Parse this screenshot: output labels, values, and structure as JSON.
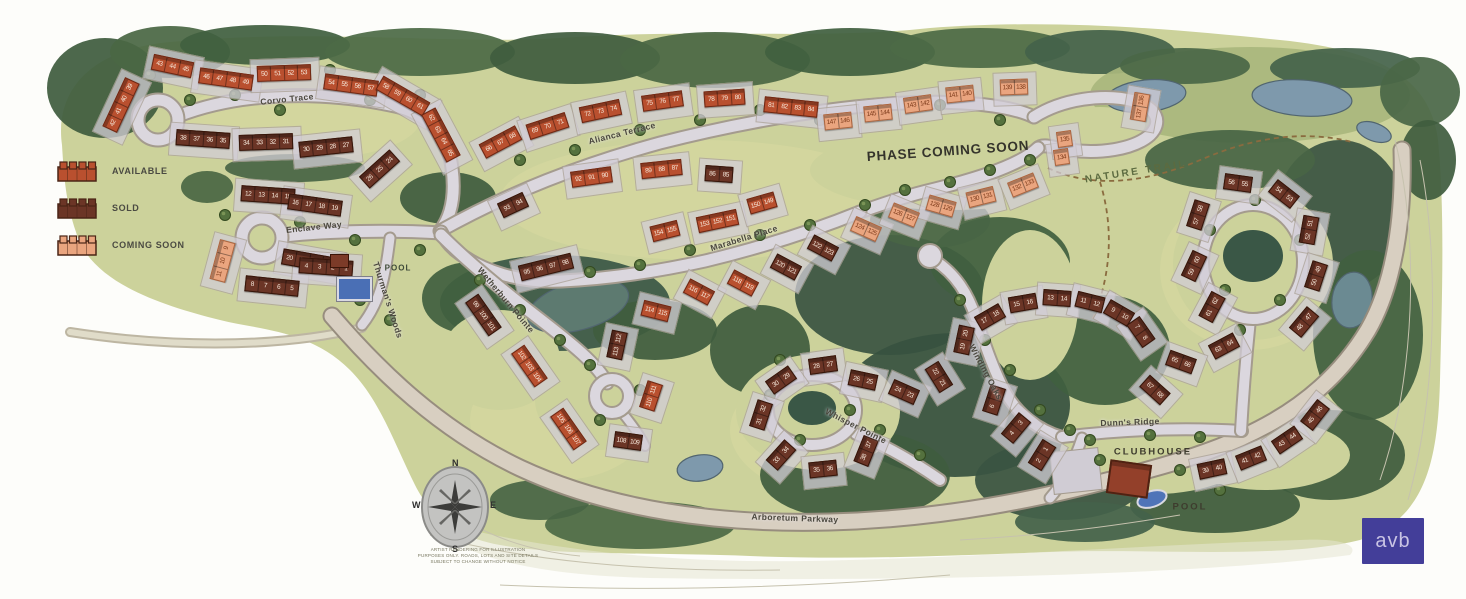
{
  "legend": {
    "items": [
      {
        "label": "AVAILABLE",
        "status": "available",
        "color": "#b9502f"
      },
      {
        "label": "SOLD",
        "status": "sold",
        "color": "#6b3526"
      },
      {
        "label": "COMING SOON",
        "status": "coming-soon",
        "color": "#eaa57f"
      }
    ]
  },
  "streets": [
    {
      "name": "Corvo Trace",
      "x": 287,
      "y": 99,
      "rot": -6
    },
    {
      "name": "Alianca Terrace",
      "x": 622,
      "y": 133,
      "rot": -14
    },
    {
      "name": "Enclave Way",
      "x": 314,
      "y": 227,
      "rot": -6
    },
    {
      "name": "Marabella Place",
      "x": 744,
      "y": 238,
      "rot": -17
    },
    {
      "name": "Wetherburn Pointe",
      "x": 506,
      "y": 300,
      "rot": 50
    },
    {
      "name": "Thurman's Woods",
      "x": 388,
      "y": 300,
      "rot": 72
    },
    {
      "name": "Whisper Pointe",
      "x": 856,
      "y": 426,
      "rot": 27
    },
    {
      "name": "Winding Oaks",
      "x": 986,
      "y": 372,
      "rot": 62
    },
    {
      "name": "Dunn's Ridge",
      "x": 1130,
      "y": 422,
      "rot": -2
    },
    {
      "name": "Arboretum Parkway",
      "x": 795,
      "y": 518,
      "rot": 2
    }
  ],
  "labels": [
    {
      "text": "PHASE COMING SOON",
      "x": 948,
      "y": 151,
      "rot": -4,
      "kind": "phase"
    },
    {
      "text": "NATURE TRAIL",
      "x": 1136,
      "y": 172,
      "rot": -9,
      "kind": "trail"
    },
    {
      "text": "POOL",
      "x": 398,
      "y": 268,
      "rot": 0,
      "kind": "small"
    },
    {
      "text": "CLUBHOUSE",
      "x": 1153,
      "y": 452,
      "rot": 0,
      "kind": "facility"
    },
    {
      "text": "POOL",
      "x": 1190,
      "y": 507,
      "rot": 0,
      "kind": "facility"
    }
  ],
  "compass": {
    "n": "N",
    "e": "E",
    "s": "S",
    "w": "W"
  },
  "disclaimer": {
    "lines": [
      "ARTIST RENDERING FOR ILLUSTRATION",
      "PURPOSES ONLY. ROADS, LOTS AND SITE DETAILS",
      "SUBJECT TO CHANGE WITHOUT NOTICE"
    ]
  },
  "logo": {
    "text": "avb"
  },
  "buildings": [
    {
      "lots": [
        "42",
        "41",
        "40",
        "39"
      ],
      "status": "available",
      "x": 121,
      "y": 106,
      "rot": -65
    },
    {
      "lots": [
        "43",
        "44",
        "45"
      ],
      "status": "available",
      "x": 172,
      "y": 67,
      "rot": 12
    },
    {
      "lots": [
        "46",
        "47",
        "48",
        "49"
      ],
      "status": "available",
      "x": 226,
      "y": 80,
      "rot": 8
    },
    {
      "lots": [
        "50",
        "51",
        "52",
        "53"
      ],
      "status": "available",
      "x": 284,
      "y": 74,
      "rot": -2
    },
    {
      "lots": [
        "54",
        "55",
        "56",
        "57"
      ],
      "status": "available",
      "x": 351,
      "y": 86,
      "rot": 8
    },
    {
      "lots": [
        "58",
        "59",
        "60",
        "61"
      ],
      "status": "available",
      "x": 403,
      "y": 97,
      "rot": 30
    },
    {
      "lots": [
        "62",
        "63",
        "64",
        "65"
      ],
      "status": "available",
      "x": 441,
      "y": 136,
      "rot": 62
    },
    {
      "lots": [
        "38",
        "37",
        "36",
        "35"
      ],
      "status": "sold",
      "x": 203,
      "y": 140,
      "rot": 4
    },
    {
      "lots": [
        "34",
        "33",
        "32",
        "31"
      ],
      "status": "sold",
      "x": 266,
      "y": 143,
      "rot": -2
    },
    {
      "lots": [
        "30",
        "29",
        "28",
        "27"
      ],
      "status": "sold",
      "x": 326,
      "y": 148,
      "rot": -6
    },
    {
      "lots": [
        "26",
        "25",
        "24"
      ],
      "status": "sold",
      "x": 379,
      "y": 170,
      "rot": -42
    },
    {
      "lots": [
        "12",
        "13",
        "14",
        "15"
      ],
      "status": "sold",
      "x": 268,
      "y": 196,
      "rot": 4
    },
    {
      "lots": [
        "16",
        "17",
        "18",
        "19"
      ],
      "status": "sold",
      "x": 315,
      "y": 206,
      "rot": 8
    },
    {
      "lots": [
        "20",
        "21",
        "22",
        "23"
      ],
      "status": "sold",
      "x": 309,
      "y": 262,
      "rot": 10
    },
    {
      "lots": [
        "11",
        "10",
        "9"
      ],
      "status": "coming-soon",
      "x": 222,
      "y": 262,
      "rot": -75
    },
    {
      "lots": [
        "8",
        "7",
        "6",
        "5"
      ],
      "status": "sold",
      "x": 272,
      "y": 287,
      "rot": 6
    },
    {
      "lots": [
        "4",
        "3",
        "2",
        "1"
      ],
      "status": "sold",
      "x": 326,
      "y": 268,
      "rot": 4
    },
    {
      "lots": [
        "66",
        "67",
        "68"
      ],
      "status": "available",
      "x": 500,
      "y": 143,
      "rot": -28
    },
    {
      "lots": [
        "69",
        "70",
        "71"
      ],
      "status": "available",
      "x": 547,
      "y": 127,
      "rot": -18
    },
    {
      "lots": [
        "72",
        "73",
        "74"
      ],
      "status": "available",
      "x": 600,
      "y": 112,
      "rot": -12
    },
    {
      "lots": [
        "75",
        "76",
        "77"
      ],
      "status": "available",
      "x": 662,
      "y": 102,
      "rot": -8
    },
    {
      "lots": [
        "78",
        "79",
        "80"
      ],
      "status": "available",
      "x": 724,
      "y": 99,
      "rot": -4
    },
    {
      "lots": [
        "81",
        "82",
        "83",
        "84"
      ],
      "status": "available",
      "x": 791,
      "y": 108,
      "rot": 6
    },
    {
      "lots": [
        "92",
        "91",
        "90"
      ],
      "status": "available",
      "x": 591,
      "y": 178,
      "rot": -8
    },
    {
      "lots": [
        "89",
        "88",
        "87"
      ],
      "status": "available",
      "x": 661,
      "y": 170,
      "rot": -6
    },
    {
      "lots": [
        "86",
        "85"
      ],
      "status": "sold",
      "x": 719,
      "y": 175,
      "rot": 4
    },
    {
      "lots": [
        "93",
        "94"
      ],
      "status": "sold",
      "x": 513,
      "y": 206,
      "rot": -25
    },
    {
      "lots": [
        "95",
        "96",
        "97",
        "98"
      ],
      "status": "sold",
      "x": 546,
      "y": 268,
      "rot": -14
    },
    {
      "lots": [
        "99",
        "100",
        "101"
      ],
      "status": "sold",
      "x": 483,
      "y": 316,
      "rot": 55
    },
    {
      "lots": [
        "102",
        "103",
        "104"
      ],
      "status": "available",
      "x": 529,
      "y": 367,
      "rot": 55
    },
    {
      "lots": [
        "105",
        "106",
        "107"
      ],
      "status": "available",
      "x": 568,
      "y": 430,
      "rot": 55
    },
    {
      "lots": [
        "108",
        "109"
      ],
      "status": "sold",
      "x": 628,
      "y": 442,
      "rot": 8
    },
    {
      "lots": [
        "110",
        "111"
      ],
      "status": "available",
      "x": 651,
      "y": 397,
      "rot": -72
    },
    {
      "lots": [
        "113",
        "112"
      ],
      "status": "sold",
      "x": 617,
      "y": 346,
      "rot": -78
    },
    {
      "lots": [
        "114",
        "115"
      ],
      "status": "available",
      "x": 656,
      "y": 312,
      "rot": 14
    },
    {
      "lots": [
        "116",
        "117"
      ],
      "status": "available",
      "x": 699,
      "y": 293,
      "rot": 28
    },
    {
      "lots": [
        "118",
        "119"
      ],
      "status": "available",
      "x": 743,
      "y": 284,
      "rot": 28
    },
    {
      "lots": [
        "120",
        "121"
      ],
      "status": "sold",
      "x": 786,
      "y": 268,
      "rot": 28
    },
    {
      "lots": [
        "122",
        "123"
      ],
      "status": "sold",
      "x": 823,
      "y": 249,
      "rot": 28
    },
    {
      "lots": [
        "154",
        "155"
      ],
      "status": "available",
      "x": 665,
      "y": 232,
      "rot": -14
    },
    {
      "lots": [
        "153",
        "152",
        "151"
      ],
      "status": "available",
      "x": 717,
      "y": 222,
      "rot": -12
    },
    {
      "lots": [
        "150",
        "149"
      ],
      "status": "available",
      "x": 762,
      "y": 204,
      "rot": -16
    },
    {
      "lots": [
        "124",
        "125"
      ],
      "status": "coming-soon",
      "x": 866,
      "y": 230,
      "rot": 24
    },
    {
      "lots": [
        "126",
        "127"
      ],
      "status": "coming-soon",
      "x": 904,
      "y": 216,
      "rot": 22
    },
    {
      "lots": [
        "128",
        "129"
      ],
      "status": "coming-soon",
      "x": 941,
      "y": 207,
      "rot": 16
    },
    {
      "lots": [
        "130",
        "131"
      ],
      "status": "coming-soon",
      "x": 981,
      "y": 198,
      "rot": -14
    },
    {
      "lots": [
        "132",
        "133"
      ],
      "status": "coming-soon",
      "x": 1023,
      "y": 186,
      "rot": -22
    },
    {
      "lots": [
        "134"
      ],
      "status": "coming-soon",
      "x": 1061,
      "y": 158,
      "rot": -8
    },
    {
      "lots": [
        "135"
      ],
      "status": "coming-soon",
      "x": 1064,
      "y": 140,
      "rot": -8
    },
    {
      "lots": [
        "147",
        "146"
      ],
      "status": "coming-soon",
      "x": 838,
      "y": 122,
      "rot": -6
    },
    {
      "lots": [
        "145",
        "144"
      ],
      "status": "coming-soon",
      "x": 878,
      "y": 114,
      "rot": -6
    },
    {
      "lots": [
        "143",
        "142"
      ],
      "status": "coming-soon",
      "x": 918,
      "y": 105,
      "rot": -8
    },
    {
      "lots": [
        "141",
        "140"
      ],
      "status": "coming-soon",
      "x": 960,
      "y": 95,
      "rot": -6
    },
    {
      "lots": [
        "139",
        "138"
      ],
      "status": "coming-soon",
      "x": 1014,
      "y": 88,
      "rot": -2
    },
    {
      "lots": [
        "137",
        "136"
      ],
      "status": "coming-soon",
      "x": 1140,
      "y": 108,
      "rot": -80
    },
    {
      "lots": [
        "28",
        "27"
      ],
      "status": "sold",
      "x": 823,
      "y": 366,
      "rot": -8
    },
    {
      "lots": [
        "30",
        "29"
      ],
      "status": "sold",
      "x": 781,
      "y": 381,
      "rot": -35
    },
    {
      "lots": [
        "26",
        "25"
      ],
      "status": "sold",
      "x": 863,
      "y": 381,
      "rot": 12
    },
    {
      "lots": [
        "24",
        "23"
      ],
      "status": "sold",
      "x": 904,
      "y": 393,
      "rot": 24
    },
    {
      "lots": [
        "22",
        "21"
      ],
      "status": "sold",
      "x": 939,
      "y": 378,
      "rot": 58
    },
    {
      "lots": [
        "31",
        "32"
      ],
      "status": "sold",
      "x": 761,
      "y": 416,
      "rot": -72
    },
    {
      "lots": [
        "33",
        "34"
      ],
      "status": "sold",
      "x": 781,
      "y": 456,
      "rot": -48
    },
    {
      "lots": [
        "35",
        "36"
      ],
      "status": "sold",
      "x": 823,
      "y": 470,
      "rot": -6
    },
    {
      "lots": [
        "38",
        "37"
      ],
      "status": "sold",
      "x": 866,
      "y": 452,
      "rot": -68
    },
    {
      "lots": [
        "19",
        "20"
      ],
      "status": "sold",
      "x": 964,
      "y": 341,
      "rot": -78
    },
    {
      "lots": [
        "17",
        "18"
      ],
      "status": "sold",
      "x": 990,
      "y": 318,
      "rot": -30
    },
    {
      "lots": [
        "15",
        "16"
      ],
      "status": "sold",
      "x": 1023,
      "y": 304,
      "rot": -10
    },
    {
      "lots": [
        "13",
        "14"
      ],
      "status": "sold",
      "x": 1057,
      "y": 299,
      "rot": 4
    },
    {
      "lots": [
        "11",
        "12"
      ],
      "status": "sold",
      "x": 1090,
      "y": 303,
      "rot": 14
    },
    {
      "lots": [
        "9",
        "10"
      ],
      "status": "sold",
      "x": 1119,
      "y": 314,
      "rot": 30
    },
    {
      "lots": [
        "7",
        "8"
      ],
      "status": "sold",
      "x": 1141,
      "y": 333,
      "rot": 55
    },
    {
      "lots": [
        "6",
        "5"
      ],
      "status": "sold",
      "x": 994,
      "y": 401,
      "rot": -72
    },
    {
      "lots": [
        "4",
        "3"
      ],
      "status": "sold",
      "x": 1016,
      "y": 429,
      "rot": -50
    },
    {
      "lots": [
        "2",
        "1"
      ],
      "status": "sold",
      "x": 1042,
      "y": 456,
      "rot": -58
    },
    {
      "lots": [
        "56",
        "55"
      ],
      "status": "sold",
      "x": 1238,
      "y": 184,
      "rot": 8
    },
    {
      "lots": [
        "54",
        "53"
      ],
      "status": "sold",
      "x": 1284,
      "y": 195,
      "rot": 38
    },
    {
      "lots": [
        "57",
        "58"
      ],
      "status": "sold",
      "x": 1198,
      "y": 216,
      "rot": -72
    },
    {
      "lots": [
        "52",
        "51"
      ],
      "status": "sold",
      "x": 1309,
      "y": 231,
      "rot": -80
    },
    {
      "lots": [
        "59",
        "60"
      ],
      "status": "sold",
      "x": 1194,
      "y": 267,
      "rot": -65
    },
    {
      "lots": [
        "50",
        "49"
      ],
      "status": "sold",
      "x": 1316,
      "y": 277,
      "rot": -72
    },
    {
      "lots": [
        "61",
        "62"
      ],
      "status": "sold",
      "x": 1212,
      "y": 308,
      "rot": -62
    },
    {
      "lots": [
        "48",
        "47"
      ],
      "status": "sold",
      "x": 1304,
      "y": 323,
      "rot": -50
    },
    {
      "lots": [
        "63",
        "64"
      ],
      "status": "sold",
      "x": 1224,
      "y": 347,
      "rot": -28
    },
    {
      "lots": [
        "65",
        "66"
      ],
      "status": "sold",
      "x": 1181,
      "y": 363,
      "rot": 20
    },
    {
      "lots": [
        "67",
        "68"
      ],
      "status": "sold",
      "x": 1155,
      "y": 391,
      "rot": 42
    },
    {
      "lots": [
        "39",
        "40"
      ],
      "status": "sold",
      "x": 1212,
      "y": 470,
      "rot": -12
    },
    {
      "lots": [
        "41",
        "42"
      ],
      "status": "sold",
      "x": 1251,
      "y": 459,
      "rot": -22
    },
    {
      "lots": [
        "43",
        "44"
      ],
      "status": "sold",
      "x": 1287,
      "y": 441,
      "rot": -34
    },
    {
      "lots": [
        "45",
        "46"
      ],
      "status": "sold",
      "x": 1315,
      "y": 416,
      "rot": -52
    }
  ]
}
